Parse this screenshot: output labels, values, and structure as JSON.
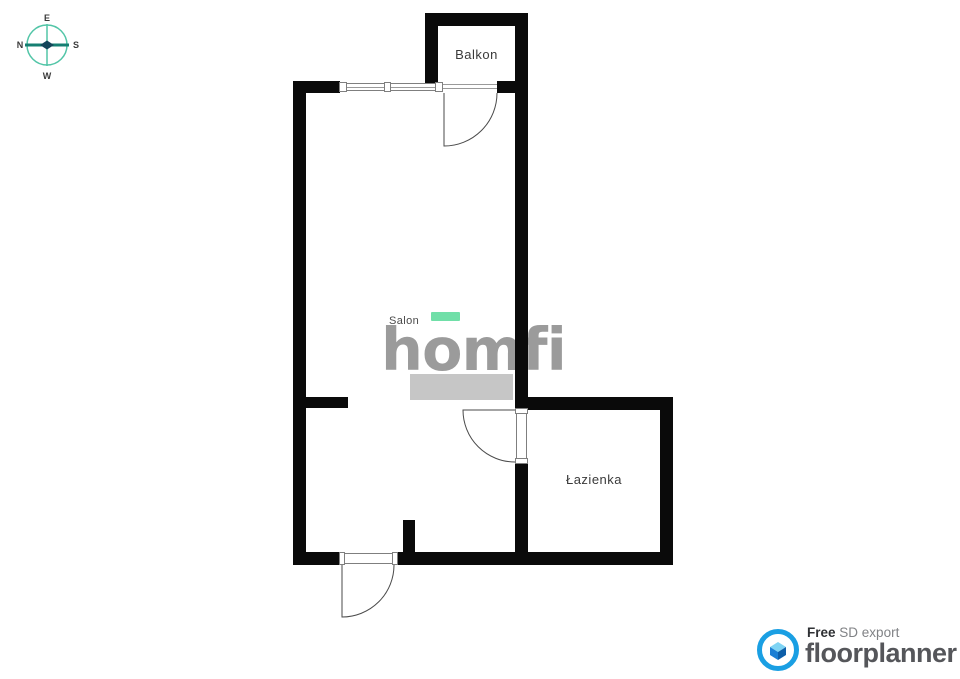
{
  "compass": {
    "n": "N",
    "e": "E",
    "s": "S",
    "w": "W"
  },
  "labels": {
    "balkon": "Balkon",
    "salon": "Salon",
    "lazienka": "Łazienka"
  },
  "watermark": {
    "brand": "homfi"
  },
  "footer": {
    "free": "Free",
    "export_type": "SD export",
    "brand": "floorplanner"
  },
  "colors": {
    "wall": "#0a0a0a",
    "accent_green": "#70dfa8",
    "watermark_gray": "#9b9b9b",
    "furniture_gray": "#c6c6c6",
    "floorplanner_blue": "#1a9fe3",
    "compass_teal": "#52c5a7",
    "compass_dark_teal": "#157f72",
    "label_text": "#3a3a3a"
  }
}
